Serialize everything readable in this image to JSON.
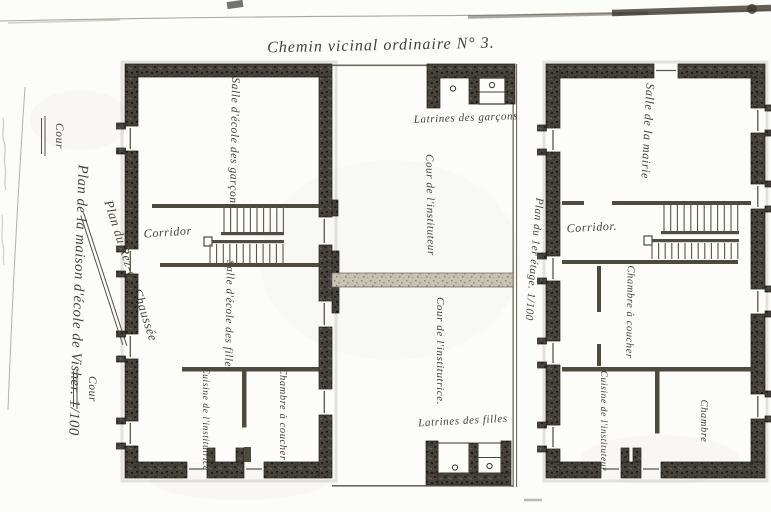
{
  "road": {
    "title": "Chemin vicinal ordinaire N° 3."
  },
  "margin": {
    "cour_top": "Cour",
    "main_title": "Plan de la maison d'école de Visher. 1/100",
    "ground_floor_label": "Plan du Rez-de-Chaussée",
    "cour_bottom": "Cour"
  },
  "ground_floor": {
    "salle_garcons": "Salle d'école des garçons",
    "corridor": "Corridor",
    "salle_filles": "Salle d'école des filles",
    "cuisine_institutrice": "Cuisine de l'institutrice",
    "chambre_a_coucher": "Chambre à coucher",
    "latrines_garcons": "Latrines des garçons",
    "cour_instituteur": "Cour de l'instituteur",
    "cour_institutrice": "Cour de l'institutrice.",
    "latrines_filles": "Latrines des filles"
  },
  "first_floor": {
    "label": "Plan du 1er étage. 1/100",
    "salle_mairie": "Salle de la mairie",
    "corridor": "Corridor.",
    "chambre_a_coucher": "Chambre à coucher",
    "cuisine_instituteur": "Cuisine de l'instituteur",
    "chambre": "Chambre"
  }
}
